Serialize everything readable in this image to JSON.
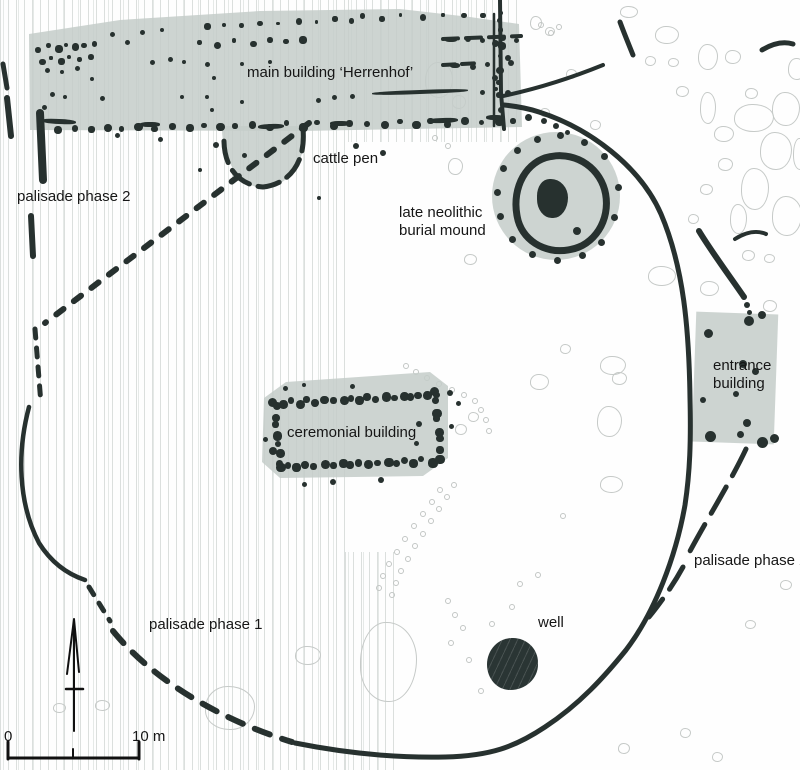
{
  "labels": {
    "main_building": "main building ‘Herrenhof’",
    "cattle_pen": "cattle pen",
    "palisade_phase2_left": "palisade phase 2",
    "burial_mound": "late neolithic burial mound",
    "ceremonial": "ceremonial building",
    "entrance": "entrance building",
    "palisade_phase2_right": "palisade phase 2",
    "palisade_phase1": "palisade phase 1",
    "well": "well",
    "scale_zero": "0",
    "scale_label": "10 m"
  },
  "colors": {
    "dark": "#27312f",
    "fill": "rgba(196,205,201,0.85)",
    "blob_outline": "#c6cac8",
    "tiny_outline": "#c2c6c4",
    "stripe": "#dadedc",
    "text": "#161616"
  },
  "features": {
    "dark_dots": [
      [
        45,
        68,
        5
      ],
      [
        60,
        70,
        4
      ],
      [
        75,
        66,
        5
      ],
      [
        50,
        92,
        5
      ],
      [
        63,
        95,
        4
      ],
      [
        42,
        105,
        5
      ],
      [
        90,
        77,
        4
      ],
      [
        100,
        96,
        5
      ],
      [
        110,
        32,
        5
      ],
      [
        125,
        40,
        5
      ],
      [
        140,
        30,
        5
      ],
      [
        160,
        28,
        4
      ],
      [
        150,
        60,
        5
      ],
      [
        168,
        57,
        5
      ],
      [
        182,
        60,
        4
      ],
      [
        205,
        62,
        5
      ],
      [
        212,
        76,
        4
      ],
      [
        240,
        62,
        4
      ],
      [
        268,
        60,
        4
      ],
      [
        205,
        95,
        4
      ],
      [
        180,
        95,
        4
      ],
      [
        210,
        108,
        4
      ],
      [
        240,
        100,
        4
      ],
      [
        316,
        98,
        5
      ],
      [
        332,
        95,
        5
      ],
      [
        350,
        94,
        5
      ],
      [
        480,
        90,
        5
      ],
      [
        494,
        87,
        4
      ],
      [
        445,
        38,
        12,
        4
      ],
      [
        465,
        36,
        6
      ],
      [
        480,
        38,
        5
      ],
      [
        500,
        35,
        6
      ],
      [
        514,
        38,
        5
      ],
      [
        450,
        63,
        10,
        5
      ],
      [
        470,
        64,
        6
      ],
      [
        485,
        62,
        5
      ],
      [
        508,
        60,
        6
      ],
      [
        492,
        40,
        7
      ],
      [
        492,
        75,
        6
      ],
      [
        505,
        55,
        6
      ],
      [
        505,
        90,
        6
      ],
      [
        115,
        133,
        5
      ],
      [
        213,
        142,
        6
      ],
      [
        242,
        153,
        5
      ],
      [
        353,
        143,
        6
      ],
      [
        380,
        150,
        6
      ],
      [
        198,
        168,
        4
      ],
      [
        158,
        137,
        5
      ],
      [
        317,
        196,
        4
      ],
      [
        237,
        175,
        4
      ],
      [
        372,
        90,
        96,
        4,
        -2
      ],
      [
        42,
        119,
        34,
        5,
        3
      ],
      [
        140,
        122,
        20,
        5,
        0
      ],
      [
        258,
        124,
        26,
        5,
        -2
      ],
      [
        330,
        121,
        20,
        5,
        0
      ],
      [
        428,
        118,
        30,
        5,
        -2
      ],
      [
        486,
        115,
        18,
        5,
        0
      ],
      [
        525,
        114,
        7
      ],
      [
        541,
        118,
        6
      ],
      [
        553,
        123,
        6
      ],
      [
        565,
        130,
        5
      ],
      [
        615,
        184,
        7
      ],
      [
        611,
        214,
        7
      ],
      [
        598,
        239,
        7
      ],
      [
        579,
        252,
        7
      ],
      [
        554,
        257,
        7
      ],
      [
        529,
        251,
        7
      ],
      [
        509,
        236,
        7
      ],
      [
        497,
        213,
        7
      ],
      [
        494,
        189,
        7
      ],
      [
        500,
        165,
        7
      ],
      [
        514,
        147,
        7
      ],
      [
        534,
        136,
        7
      ],
      [
        557,
        132,
        7
      ],
      [
        581,
        139,
        7
      ],
      [
        601,
        153,
        7
      ],
      [
        573,
        227,
        8
      ],
      [
        447,
        390,
        6
      ],
      [
        456,
        401,
        5
      ],
      [
        449,
        424,
        5
      ],
      [
        416,
        421,
        6
      ],
      [
        414,
        441,
        5
      ],
      [
        330,
        479,
        6
      ],
      [
        378,
        477,
        6
      ],
      [
        302,
        482,
        5
      ],
      [
        263,
        437,
        5
      ],
      [
        283,
        386,
        5
      ],
      [
        302,
        383,
        4
      ],
      [
        350,
        384,
        5
      ],
      [
        430,
        387,
        9
      ],
      [
        268,
        398,
        9
      ],
      [
        269,
        447,
        8
      ],
      [
        744,
        316,
        10
      ],
      [
        758,
        311,
        8
      ],
      [
        704,
        329,
        9
      ],
      [
        739,
        360,
        8
      ],
      [
        752,
        368,
        7
      ],
      [
        733,
        391,
        6
      ],
      [
        700,
        397,
        6
      ],
      [
        705,
        431,
        11
      ],
      [
        743,
        419,
        8
      ],
      [
        737,
        431,
        7
      ],
      [
        757,
        437,
        11
      ],
      [
        770,
        434,
        9
      ],
      [
        744,
        302,
        6
      ],
      [
        747,
        310,
        5
      ]
    ],
    "dot_rows": [
      {
        "a": [
          35,
          45
        ],
        "b": [
          92,
          42
        ],
        "n": 7,
        "s": 6
      },
      {
        "a": [
          38,
          58
        ],
        "b": [
          88,
          55
        ],
        "n": 6,
        "s": 5
      },
      {
        "a": [
          203,
          24
        ],
        "b": [
          350,
          17
        ],
        "n": 9,
        "s": 5
      },
      {
        "a": [
          360,
          15
        ],
        "b": [
          500,
          12
        ],
        "n": 8,
        "s": 5
      },
      {
        "a": [
          198,
          41
        ],
        "b": [
          300,
          37
        ],
        "n": 7,
        "s": 6
      },
      {
        "a": [
          38,
          126
        ],
        "b": [
          510,
          118
        ],
        "n": 30,
        "s": 7
      },
      {
        "a": [
          497,
          16
        ],
        "b": [
          497,
          118
        ],
        "n": 9,
        "s": 6
      },
      {
        "a": [
          278,
          399
        ],
        "b": [
          433,
          391
        ],
        "n": 19,
        "s": 8
      },
      {
        "a": [
          275,
          463
        ],
        "b": [
          428,
          457
        ],
        "n": 18,
        "s": 8
      },
      {
        "a": [
          272,
          403
        ],
        "b": [
          275,
          459
        ],
        "n": 7,
        "s": 8
      },
      {
        "a": [
          433,
          398
        ],
        "b": [
          436,
          455
        ],
        "n": 7,
        "s": 8
      }
    ],
    "blobs": [
      [
        530,
        16,
        10,
        12
      ],
      [
        545,
        27,
        8,
        7
      ],
      [
        566,
        69,
        9,
        8
      ],
      [
        540,
        108,
        8,
        7
      ],
      [
        590,
        120,
        9,
        8
      ],
      [
        425,
        62,
        26,
        34
      ],
      [
        452,
        95,
        12,
        12
      ],
      [
        620,
        6,
        16,
        10
      ],
      [
        655,
        26,
        22,
        16
      ],
      [
        645,
        56,
        9,
        8
      ],
      [
        668,
        58,
        9,
        7
      ],
      [
        698,
        44,
        18,
        24
      ],
      [
        725,
        50,
        14,
        12
      ],
      [
        676,
        86,
        11,
        9
      ],
      [
        745,
        88,
        11,
        9
      ],
      [
        700,
        92,
        14,
        30
      ],
      [
        772,
        92,
        26,
        32
      ],
      [
        788,
        58,
        16,
        20
      ],
      [
        734,
        104,
        38,
        26
      ],
      [
        714,
        126,
        18,
        14
      ],
      [
        760,
        132,
        30,
        36
      ],
      [
        793,
        138,
        12,
        30
      ],
      [
        718,
        158,
        13,
        11
      ],
      [
        741,
        168,
        26,
        40
      ],
      [
        700,
        184,
        11,
        9
      ],
      [
        772,
        196,
        28,
        38
      ],
      [
        730,
        204,
        15,
        28
      ],
      [
        688,
        214,
        9,
        8
      ],
      [
        742,
        250,
        11,
        9
      ],
      [
        764,
        254,
        9,
        7
      ],
      [
        648,
        266,
        26,
        18
      ],
      [
        700,
        281,
        17,
        13
      ],
      [
        530,
        374,
        17,
        14
      ],
      [
        600,
        356,
        24,
        17
      ],
      [
        612,
        372,
        13,
        11
      ],
      [
        597,
        406,
        23,
        29
      ],
      [
        600,
        476,
        21,
        15
      ],
      [
        455,
        424,
        10,
        9
      ],
      [
        468,
        412,
        9,
        8
      ],
      [
        560,
        344,
        9,
        8
      ],
      [
        360,
        622,
        55,
        78
      ],
      [
        295,
        646,
        24,
        17
      ],
      [
        205,
        686,
        48,
        42
      ],
      [
        95,
        700,
        13,
        9
      ],
      [
        53,
        703,
        11,
        8
      ],
      [
        680,
        728,
        9,
        8
      ],
      [
        712,
        752,
        9,
        8
      ],
      [
        618,
        743,
        10,
        9
      ],
      [
        464,
        254,
        11,
        9
      ],
      [
        448,
        158,
        13,
        15
      ],
      [
        763,
        300,
        12,
        10
      ],
      [
        780,
        580,
        10,
        8
      ],
      [
        745,
        620,
        9,
        7
      ]
    ],
    "tiny": [
      [
        403,
        363
      ],
      [
        413,
        369
      ],
      [
        424,
        375
      ],
      [
        436,
        381
      ],
      [
        449,
        387
      ],
      [
        461,
        392
      ],
      [
        472,
        398
      ],
      [
        478,
        407
      ],
      [
        483,
        417
      ],
      [
        486,
        428
      ],
      [
        437,
        487
      ],
      [
        429,
        499
      ],
      [
        420,
        511
      ],
      [
        411,
        523
      ],
      [
        402,
        536
      ],
      [
        394,
        549
      ],
      [
        386,
        561
      ],
      [
        380,
        573
      ],
      [
        376,
        585
      ],
      [
        451,
        482
      ],
      [
        444,
        494
      ],
      [
        436,
        506
      ],
      [
        428,
        518
      ],
      [
        420,
        531
      ],
      [
        412,
        543
      ],
      [
        405,
        556
      ],
      [
        398,
        568
      ],
      [
        393,
        580
      ],
      [
        389,
        592
      ],
      [
        560,
        513
      ],
      [
        535,
        572
      ],
      [
        517,
        581
      ],
      [
        509,
        604
      ],
      [
        489,
        621
      ],
      [
        466,
        657
      ],
      [
        478,
        688
      ],
      [
        448,
        640
      ],
      [
        538,
        22
      ],
      [
        548,
        30
      ],
      [
        556,
        24
      ],
      [
        432,
        135
      ],
      [
        445,
        143
      ],
      [
        445,
        598
      ],
      [
        452,
        612
      ],
      [
        460,
        625
      ]
    ]
  }
}
